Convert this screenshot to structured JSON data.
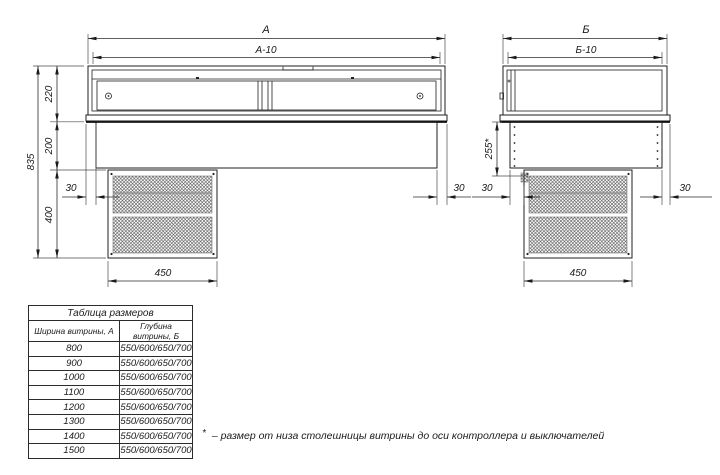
{
  "drawing": {
    "front_view": {
      "dim_width": "А",
      "dim_width_inner": "А-10",
      "dim_total_height": "835",
      "dim_case_height": "220",
      "dim_base_height": "200",
      "dim_unit_height": "400",
      "dim_offset_left": "30",
      "dim_offset_right": "30",
      "dim_unit_width": "450"
    },
    "side_view": {
      "dim_depth": "Б",
      "dim_depth_inner": "Б-10",
      "dim_controller_axis": "255*",
      "dim_offset_left": "30",
      "dim_offset_right": "30",
      "dim_unit_width": "450"
    }
  },
  "table": {
    "title": "Таблица размеров",
    "columns": [
      "Ширина витрины, А",
      "Глубина витрины, Б"
    ],
    "rows": [
      [
        "800",
        "550/600/650/700"
      ],
      [
        "900",
        "550/600/650/700"
      ],
      [
        "1000",
        "550/600/650/700"
      ],
      [
        "1100",
        "550/600/650/700"
      ],
      [
        "1200",
        "550/600/650/700"
      ],
      [
        "1300",
        "550/600/650/700"
      ],
      [
        "1400",
        "550/600/650/700"
      ],
      [
        "1500",
        "550/600/650/700"
      ]
    ]
  },
  "footnote": {
    "marker": "*",
    "text": "– размер от низа столешницы витрины до оси контроллера и выключателей"
  },
  "colors": {
    "line": "#1f1f1f",
    "background": "#ffffff"
  }
}
